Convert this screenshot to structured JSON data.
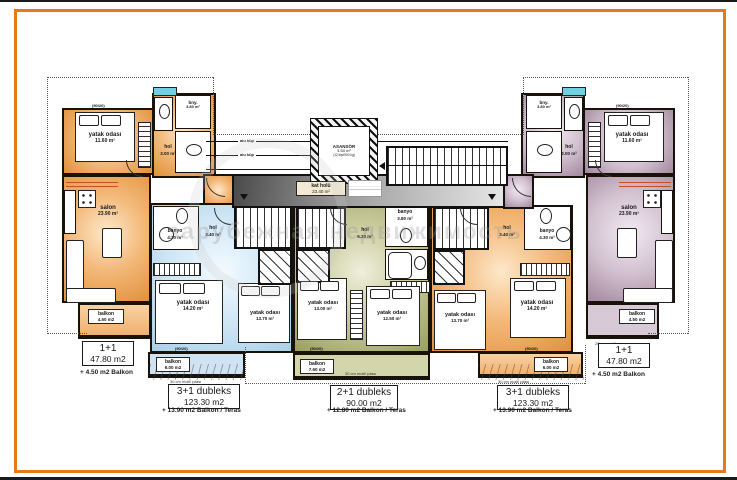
{
  "colors": {
    "frame": "#e67a17",
    "orange_unit": "#eda45c",
    "blue_unit": "#bcd9ee",
    "green_unit": "#a7ac69",
    "purple_unit": "#b094ac",
    "wall": "#1a1a1a"
  },
  "units": [
    {
      "label": "1+1",
      "area": "47.80 m2",
      "extra": "+ 4.50 m2 Balkon",
      "rooms": {
        "bedroom_name": "yatak odası",
        "bedroom_area": "11.60 m²",
        "salon_name": "salon",
        "salon_area": "23.90 m²",
        "hol_name": "hol",
        "hol_area": "3.00 m²",
        "bath_name": "bny.",
        "bath_area": "3.80 m²",
        "balcony_name": "balkon",
        "balcony_area": "4.50 m2"
      }
    },
    {
      "label": "3+1 dubleks",
      "area": "123.30 m2",
      "extra": "+ 13.90 m2 Balkon / Teras",
      "rooms": {
        "banyo_name": "banyo",
        "banyo_area": "4.30 m²",
        "hol_name": "hol",
        "hol_area": "3.40 m²",
        "bed1_name": "yatak odası",
        "bed1_area": "14.20 m²",
        "bed2_name": "yatak odası",
        "bed2_area": "13.70 m²",
        "balcony_name": "balkon",
        "balcony_area": "6.00 m2"
      }
    },
    {
      "label": "2+1 dubleks",
      "area": "90.00 m2",
      "extra": "+ 12.80 m2 Balkon / Teras",
      "rooms": {
        "banyo_name": "banyo",
        "banyo_area": "3.80 m²",
        "hol_name": "hol",
        "hol_area": "5.20 m²",
        "bed1_name": "yatak odası",
        "bed1_area": "13.00 m²",
        "bed2_name": "yatak odası",
        "bed2_area": "12.50 m²",
        "balcony_name": "balkon",
        "balcony_area": "7.60 m2"
      }
    },
    {
      "label": "3+1 dubleks",
      "area": "123.30 m2",
      "extra": "+ 13.90 m2 Balkon / Teras",
      "rooms": {
        "banyo_name": "banyo",
        "banyo_area": "4.30 m²",
        "hol_name": "hol",
        "hol_area": "3.40 m²",
        "bed1_name": "yatak odası",
        "bed1_area": "13.70 m²",
        "bed2_name": "yatak odası",
        "bed2_area": "14.20 m²",
        "balcony_name": "balkon",
        "balcony_area": "6.00 m2"
      }
    },
    {
      "label": "1+1",
      "area": "47.80 m2",
      "extra": "+ 4.50 m2 Balkon",
      "rooms": {
        "bedroom_name": "yatak odası",
        "bedroom_area": "11.60 m²",
        "salon_name": "salon",
        "salon_area": "23.90 m²",
        "hol_name": "hol",
        "hol_area": "3.00 m²",
        "bath_name": "bny.",
        "bath_area": "3.80 m²",
        "balcony_name": "balkon",
        "balcony_area": "4.50 m2"
      }
    }
  ],
  "core": {
    "elevator_name": "ASANSÖR",
    "elevator_area": "4.50 m²",
    "elevator_capacity": "(12 kişi/900 kg)",
    "hall_name": "kat holü",
    "hall_area": "23.40 m²",
    "railing_label": "alu küp"
  },
  "notes": {
    "under_small": "20 cm motif çıtası",
    "under_big": "30 cm motif çıtası",
    "window_tag": "(90/20)"
  },
  "watermark": {
    "text": "зарубежная недвижимость"
  }
}
